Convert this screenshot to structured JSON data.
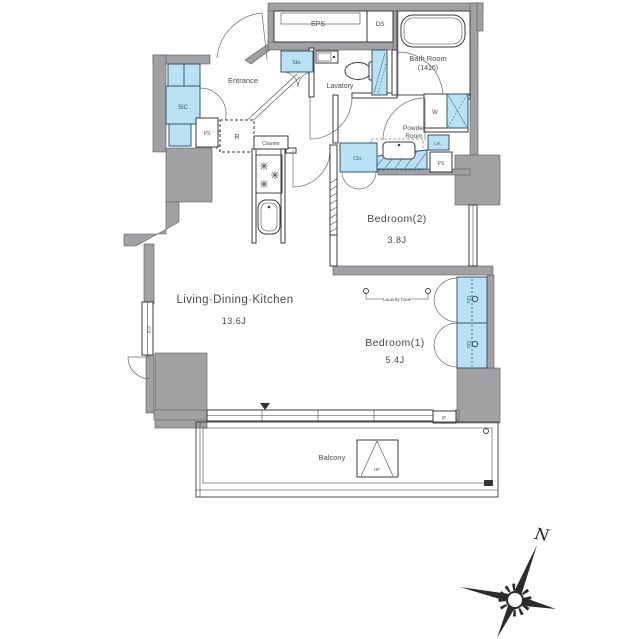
{
  "floor_plan": {
    "rooms": {
      "ldk": {
        "name": "Living·Dining·Kitchen",
        "size": "13.6J"
      },
      "bedroom1": {
        "name": "Bedroom(1)",
        "size": "5.4J"
      },
      "bedroom2": {
        "name": "Bedroom(2)",
        "size": "3.8J"
      },
      "entrance": {
        "name": "Entrance"
      },
      "lavatory": {
        "name": "Lavatory"
      },
      "bath": {
        "name": "Bath Room",
        "size": "(1416)"
      },
      "powder": {
        "line1": "Powder",
        "line2": "Room"
      },
      "balcony": {
        "name": "Balcony"
      }
    },
    "fixtures": {
      "eps": "EPS",
      "ds": "DS",
      "sto": "Sto.",
      "sic": "SIC",
      "ps": "PS",
      "refrigerator": "R",
      "counter": "Counter",
      "washer": "W",
      "linen": "Lin.",
      "closet": "Clo.",
      "fix_window": "FIX",
      "laundry_hook": "Laundry hook",
      "hatch": "HF",
      "pipe": "P"
    },
    "compass": {
      "north": "N"
    },
    "colors": {
      "wall": "#a1a1a4",
      "water": "#b9e1f3",
      "line": "#3a3a40"
    }
  }
}
